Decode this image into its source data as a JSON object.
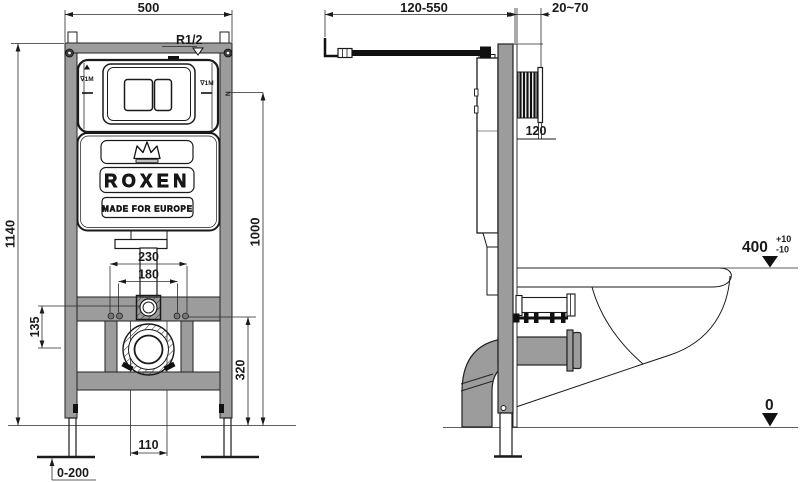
{
  "drawing": {
    "title_hint": "wall-hung WC installation frame drawing",
    "colors": {
      "frame_fill": "#9c9c9c",
      "line": "#1a1a1a",
      "background": "#ffffff"
    },
    "front_view": {
      "brand": {
        "name": "ROXEN",
        "tagline": "MADE FOR EUROPE"
      },
      "labels": {
        "thread": "R1/2",
        "level_left": "∇1M",
        "level_right": "∇1M",
        "rail_mark": "N"
      },
      "dims": {
        "frame_width": "500",
        "frame_height": "1140",
        "inlet_drain_offset": "135",
        "bolt_outer": "230",
        "bolt_inner": "180",
        "plate_center_height": "1000",
        "drain_center_height": "320",
        "drain_width": "110",
        "leg_adjust": "0-200"
      }
    },
    "side_view": {
      "dims": {
        "depth_range": "120-550",
        "wall_gap": "20~70",
        "connector": "120",
        "seat_height": "400",
        "seat_tol_plus": "+10",
        "seat_tol_minus": "-10",
        "floor_level": "0"
      }
    }
  }
}
